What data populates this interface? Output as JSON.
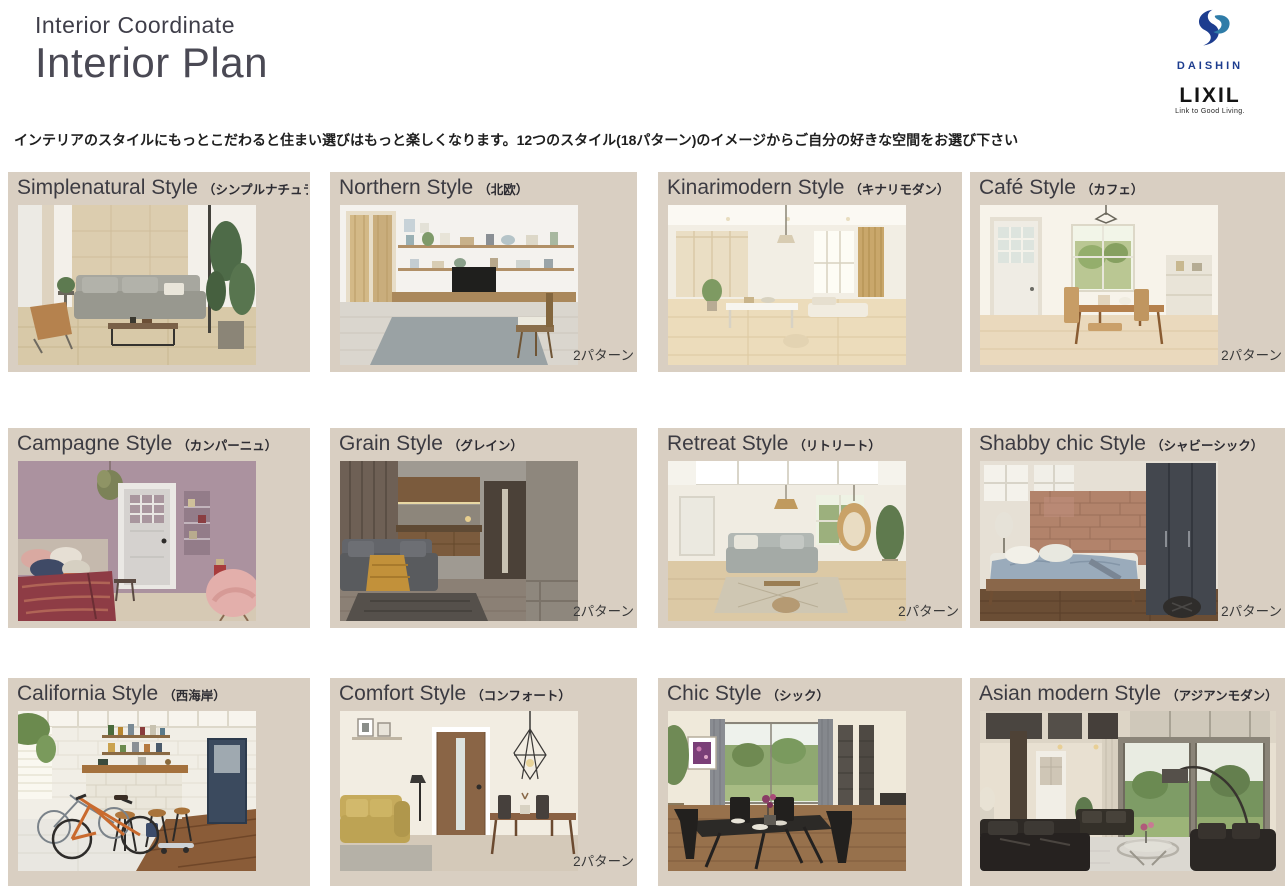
{
  "header": {
    "supertitle": "Interior Coordinate",
    "title": "Interior Plan",
    "description": "インテリアのスタイルにもっとこだわると住まい選びはもっと楽しくなります。12つのスタイル(18パターン)のイメージからご自分の好きな空間をお選び下さい"
  },
  "logos": {
    "daishin": "DAISHIN",
    "lixil": "LIXIL",
    "lixil_tagline": "Link to Good Living."
  },
  "cards": [
    {
      "title": "Simplenatural Style",
      "subtitle": "（シンプルナチュラル）",
      "badge": "",
      "photo_alt": "Living room with wood panel wall, gray sofa and tall green plant"
    },
    {
      "title": "Northern Style",
      "subtitle": "（北欧）",
      "badge": "2パターン",
      "photo_alt": "White room with wall shelves, low wooden TV board and wooden doors"
    },
    {
      "title": "Kinarimodern Style",
      "subtitle": "（キナリモダン）",
      "badge": "",
      "photo_alt": "Bright natural-wood dining space with sliding screens"
    },
    {
      "title": "Café Style",
      "subtitle": "（カフェ）",
      "badge": "2パターン",
      "photo_alt": "Sunny dining room with white glazed door and wooden table"
    },
    {
      "title": "Campagne Style",
      "subtitle": "（カンパーニュ）",
      "badge": "",
      "photo_alt": "Bedroom with mauve wall, gray door and burgundy bedding"
    },
    {
      "title": "Grain Style",
      "subtitle": "（グレイン）",
      "badge": "2パターン",
      "photo_alt": "Dark-toned living room with wood kitchen and gray sofa"
    },
    {
      "title": "Retreat Style",
      "subtitle": "（リトリート）",
      "badge": "2パターン",
      "photo_alt": "Airy living room with light wood floor, gray sofa and hanging chair"
    },
    {
      "title": "Shabby chic Style",
      "subtitle": "（シャビーシック）",
      "badge": "2パターン",
      "photo_alt": "Bedroom with brick wall, dark wardrobe and blue-gray bedding"
    },
    {
      "title": "California Style",
      "subtitle": "（西海岸）",
      "badge": "",
      "photo_alt": "Industrial room with white brick bar counter, stools and bicycles"
    },
    {
      "title": "Comfort Style",
      "subtitle": "（コンフォート）",
      "badge": "2パターン",
      "photo_alt": "Room with wooden door, mustard sofa and wire pendant lamp"
    },
    {
      "title": "Chic Style",
      "subtitle": "（シック）",
      "badge": "",
      "photo_alt": "Dining room with black table and chairs facing a garden window"
    },
    {
      "title": "Asian modern Style",
      "subtitle": "（アジアンモダン）",
      "badge": "",
      "photo_alt": "Double-height living room with black leather sofas and garden view"
    }
  ]
}
